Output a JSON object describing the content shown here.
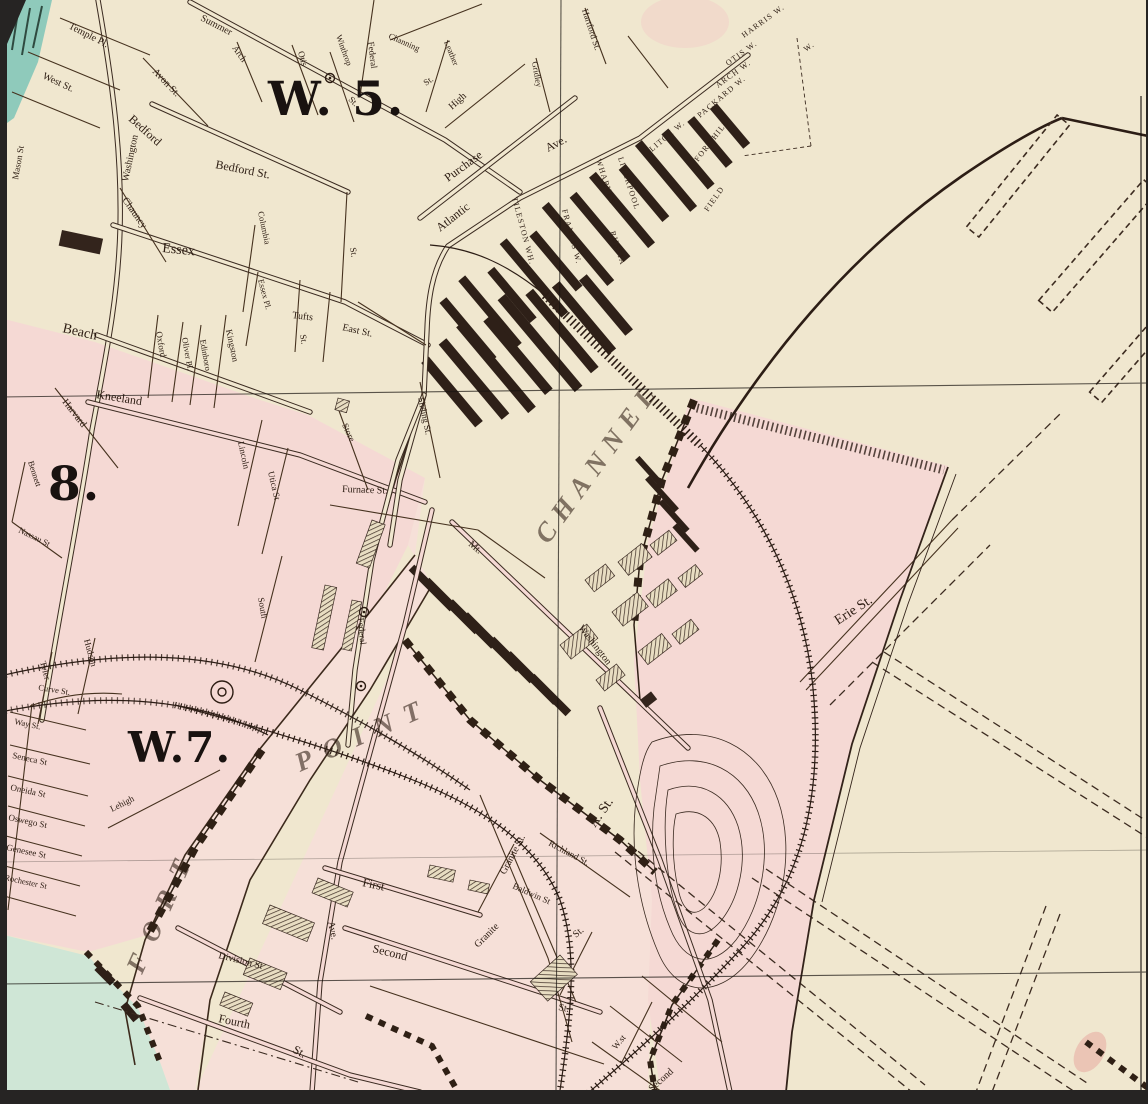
{
  "map": {
    "wards": {
      "w5": "W. 5.",
      "w8": "8.",
      "w7": "W.7."
    },
    "water": {
      "fort": "FORT",
      "point": "POINT",
      "channel": "CHANNEL"
    },
    "streets": {
      "mason": "Mason St",
      "washington": "Washington",
      "west": "West St.",
      "temple": "Temple Pl.",
      "avon": "Avon St.",
      "summer": "Summer",
      "bedford": "Bedford",
      "bedford_st": "Bedford St.",
      "chauncy": "Chauncy",
      "essex": "Essex",
      "columbia": "Columbia",
      "otis": "Otis",
      "winthrop": "Winthrop",
      "arch": "Arch",
      "federal": "Federal",
      "channing": "Channing",
      "leather": "Leather",
      "high": "High",
      "gridley": "Gridley",
      "hartford": "Hartford St.",
      "purchase": "Purchase",
      "atlantic": "Atlantic",
      "ave": "Ave.",
      "oxford": "Oxford",
      "oliver_pl": "Oliver Pl.",
      "edinboro": "Edinboro",
      "kingston": "Kingston",
      "essex_pl": "Essex Pl.",
      "beach": "Beach",
      "kneeland": "Kneeland",
      "tufts": "Tufts",
      "east": "East St.",
      "harvard": "Harvard",
      "bennett": "Bennett",
      "nassau": "Nassau St",
      "lincoln": "Lincoln",
      "utica": "Utica St",
      "south": "South",
      "store": "Store",
      "sliding": "Sliding St.",
      "furnace": "Furnace St.",
      "tyler": "Tyler",
      "hudson": "Hudson",
      "curve": "Curve St.",
      "way": "Way St.",
      "seneca": "Seneca St",
      "oneida": "Oneida St",
      "oswego": "Oswego St",
      "genesee": "Genesee St",
      "rochester": "Rochester St",
      "lehigh": "Lehigh",
      "division": "Division St",
      "dorchester_ave": "Ave.",
      "fourth": "Fourth",
      "first": "First",
      "second": "Second",
      "mt": "Mt.",
      "washington_sb": "Washington",
      "a_st": "A. St.",
      "granite": "Granite St.",
      "granite2": "Granite",
      "baldwin": "Baldwin St",
      "richland": "Richland St.",
      "erie": "Erie St.",
      "w_st": "W.st",
      "second2": "Second",
      "st": "St."
    },
    "wharves": {
      "harris": "HARRIS W.",
      "otis_w": "OTIS W.",
      "arch_w": "ARCH W.",
      "packard": "PACKARD W.",
      "fort_hill": "FORT HILL",
      "w_abbrev": "W.",
      "litch": "LITCH W.",
      "field": "FIELD",
      "liverpool": "LIVERPOOL",
      "wharves": "WHARVES",
      "russia": "RUSSIA",
      "tileston": "TILESTON WH.",
      "francis": "FRANCIS W."
    },
    "colors": {
      "paper": "#f0e7cf",
      "pink": "#f5d9d4",
      "pink_flat": "#f6e0d8",
      "teal": "#8fcabb",
      "teal_light": "#cfe6d6",
      "ink": "#3a2a20",
      "viewer_bg": "#262423",
      "rose": "#e8a9a0"
    }
  }
}
